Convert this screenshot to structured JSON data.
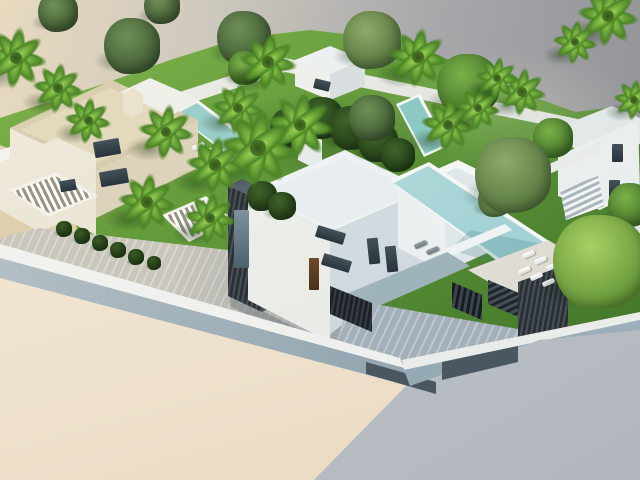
{
  "meta": {
    "description": "Aerial 3D architectural rendering of a modern villa development: white flat-roofed villas with infinity pools, palm trees, lawns and a blue-gray perimeter wall on a cut-away model base",
    "canvas": {
      "width": 640,
      "height": 480
    }
  },
  "palette": {
    "bg1": "#e8dabf",
    "bg2": "#cdc8bd",
    "bg3": "#a8a8ab",
    "bg4": "#96979b",
    "lawn_light": "#86b94f",
    "lawn_mid": "#62993a",
    "lawn_dark": "#3f6f28",
    "pool_rim": "#f4f7f6",
    "pool_1": "#a9d6cf",
    "pool_2": "#76bcb8",
    "pool_3": "#cfe9e8",
    "pool_4": "#8cc6cb",
    "white_1": "#f4f6f6",
    "white_2": "#e2e8ea",
    "white_3": "#c9d3d9",
    "cream_1": "#f0ebdc",
    "cream_2": "#ddd2b5",
    "cream_3": "#c9bb98",
    "slate_1": "#3a4149",
    "slate_2": "#272d34",
    "slate_3": "#4e565f",
    "wall_top": "#edefec",
    "wall_1": "#b2bfc4",
    "wall_2": "#7e95a4",
    "gate": "#4a5660",
    "pav_1": "#c9c6bc",
    "pav_2": "#a3afb9",
    "cut_cream_1": "#f7eedd",
    "cut_cream_2": "#e9d9c0",
    "cut_gray_1": "#c6cbd1",
    "cut_gray_2": "#b2b7be",
    "glass": "#3e4a52",
    "door": "#5e3f22",
    "palm_light": "#90c94e",
    "palm_dark": "#4c8526"
  },
  "scene": {
    "trees": [
      {
        "type": "hedge",
        "x": 64,
        "y": 229,
        "s": 16
      },
      {
        "type": "hedge",
        "x": 82,
        "y": 236,
        "s": 16
      },
      {
        "type": "hedge",
        "x": 100,
        "y": 243,
        "s": 16
      },
      {
        "type": "hedge",
        "x": 118,
        "y": 250,
        "s": 16
      },
      {
        "type": "hedge",
        "x": 136,
        "y": 257,
        "s": 16
      },
      {
        "type": "hedge",
        "x": 154,
        "y": 263,
        "s": 14
      },
      {
        "type": "hedge",
        "x": 262,
        "y": 196,
        "s": 30
      },
      {
        "type": "hedge",
        "x": 282,
        "y": 206,
        "s": 28
      },
      {
        "type": "hedge",
        "x": 290,
        "y": 128,
        "s": 40
      },
      {
        "type": "hedge",
        "x": 322,
        "y": 118,
        "s": 42
      },
      {
        "type": "hedge",
        "x": 352,
        "y": 128,
        "s": 44
      },
      {
        "type": "hedge",
        "x": 378,
        "y": 142,
        "s": 40
      },
      {
        "type": "hedge",
        "x": 398,
        "y": 155,
        "s": 34
      },
      {
        "type": "olive",
        "x": 58,
        "y": 12,
        "s": 40
      },
      {
        "type": "olive",
        "x": 162,
        "y": 6,
        "s": 36
      },
      {
        "type": "olive",
        "x": 132,
        "y": 46,
        "s": 56
      },
      {
        "type": "olive",
        "x": 244,
        "y": 38,
        "s": 54
      },
      {
        "type": "round",
        "x": 245,
        "y": 68,
        "s": 34
      },
      {
        "type": "pine",
        "x": 372,
        "y": 40,
        "s": 58
      },
      {
        "type": "olive",
        "x": 372,
        "y": 118,
        "s": 46
      },
      {
        "type": "round",
        "x": 468,
        "y": 85,
        "s": 62
      },
      {
        "type": "round",
        "x": 553,
        "y": 138,
        "s": 40
      },
      {
        "type": "pine",
        "x": 495,
        "y": 200,
        "s": 34
      },
      {
        "type": "pine",
        "x": 513,
        "y": 175,
        "s": 76
      },
      {
        "type": "round",
        "x": 630,
        "y": 205,
        "s": 44
      },
      {
        "type": "bright",
        "x": 600,
        "y": 262,
        "s": 94
      },
      {
        "type": "palm",
        "x": 16,
        "y": 58,
        "s": 66
      },
      {
        "type": "palm",
        "x": 58,
        "y": 88,
        "s": 54
      },
      {
        "type": "palm",
        "x": 88,
        "y": 120,
        "s": 50
      },
      {
        "type": "palm",
        "x": 268,
        "y": 62,
        "s": 62
      },
      {
        "type": "palm",
        "x": 238,
        "y": 108,
        "s": 56
      },
      {
        "type": "palm",
        "x": 166,
        "y": 132,
        "s": 60
      },
      {
        "type": "palm",
        "x": 300,
        "y": 125,
        "s": 72
      },
      {
        "type": "palm",
        "x": 258,
        "y": 148,
        "s": 84
      },
      {
        "type": "palm",
        "x": 215,
        "y": 165,
        "s": 62
      },
      {
        "type": "palm",
        "x": 418,
        "y": 57,
        "s": 64
      },
      {
        "type": "palm",
        "x": 448,
        "y": 125,
        "s": 58
      },
      {
        "type": "palm",
        "x": 478,
        "y": 108,
        "s": 48
      },
      {
        "type": "palm",
        "x": 522,
        "y": 92,
        "s": 52
      },
      {
        "type": "palm",
        "x": 497,
        "y": 78,
        "s": 46
      },
      {
        "type": "palm",
        "x": 608,
        "y": 16,
        "s": 66
      },
      {
        "type": "palm",
        "x": 575,
        "y": 42,
        "s": 48
      },
      {
        "type": "palm",
        "x": 634,
        "y": 100,
        "s": 44
      },
      {
        "type": "palm",
        "x": 147,
        "y": 202,
        "s": 62
      },
      {
        "type": "palm",
        "x": 210,
        "y": 218,
        "s": 56
      }
    ],
    "loungers": [
      {
        "x": 198,
        "y": 146,
        "r": -24
      },
      {
        "x": 208,
        "y": 151,
        "r": -24
      },
      {
        "x": 218,
        "y": 156,
        "r": -24
      },
      {
        "x": 228,
        "y": 161,
        "r": -24
      },
      {
        "x": 420,
        "y": 244,
        "r": -24,
        "dark": true
      },
      {
        "x": 432,
        "y": 250,
        "r": -24,
        "dark": true
      },
      {
        "x": 528,
        "y": 254,
        "r": -24
      },
      {
        "x": 540,
        "y": 260,
        "r": -24
      },
      {
        "x": 552,
        "y": 266,
        "r": -24
      },
      {
        "x": 524,
        "y": 270,
        "r": -24
      },
      {
        "x": 536,
        "y": 276,
        "r": -24
      },
      {
        "x": 548,
        "y": 282,
        "r": -24
      }
    ],
    "windows": [
      {
        "x": 94,
        "y": 140,
        "w": 26,
        "h": 16,
        "r": -10,
        "c": "glass"
      },
      {
        "x": 100,
        "y": 170,
        "w": 28,
        "h": 15,
        "r": -10,
        "c": "glass"
      },
      {
        "x": 60,
        "y": 180,
        "w": 16,
        "h": 11,
        "r": -10,
        "c": "glass"
      },
      {
        "x": 316,
        "y": 229,
        "w": 29,
        "h": 12,
        "r": 17,
        "c": "glass"
      },
      {
        "x": 322,
        "y": 257,
        "w": 29,
        "h": 12,
        "r": 17,
        "c": "glass"
      },
      {
        "x": 309,
        "y": 258,
        "w": 10,
        "h": 32,
        "r": 0,
        "c": "door"
      },
      {
        "x": 368,
        "y": 238,
        "w": 11,
        "h": 26,
        "r": -6,
        "c": "glass"
      },
      {
        "x": 386,
        "y": 246,
        "w": 11,
        "h": 26,
        "r": -6,
        "c": "glass"
      },
      {
        "x": 234,
        "y": 210,
        "w": 15,
        "h": 58,
        "r": 0,
        "c": "glasslight"
      },
      {
        "x": 300,
        "y": 138,
        "w": 16,
        "h": 6,
        "r": 13,
        "c": "slate"
      },
      {
        "x": 314,
        "y": 80,
        "w": 16,
        "h": 10,
        "r": 14,
        "c": "glass"
      },
      {
        "x": 612,
        "y": 144,
        "w": 11,
        "h": 18,
        "r": 0,
        "c": "glass"
      },
      {
        "x": 609,
        "y": 180,
        "w": 11,
        "h": 18,
        "r": 0,
        "c": "glass"
      },
      {
        "x": 614,
        "y": 242,
        "w": 11,
        "h": 15,
        "r": 0,
        "c": "glass"
      }
    ]
  }
}
